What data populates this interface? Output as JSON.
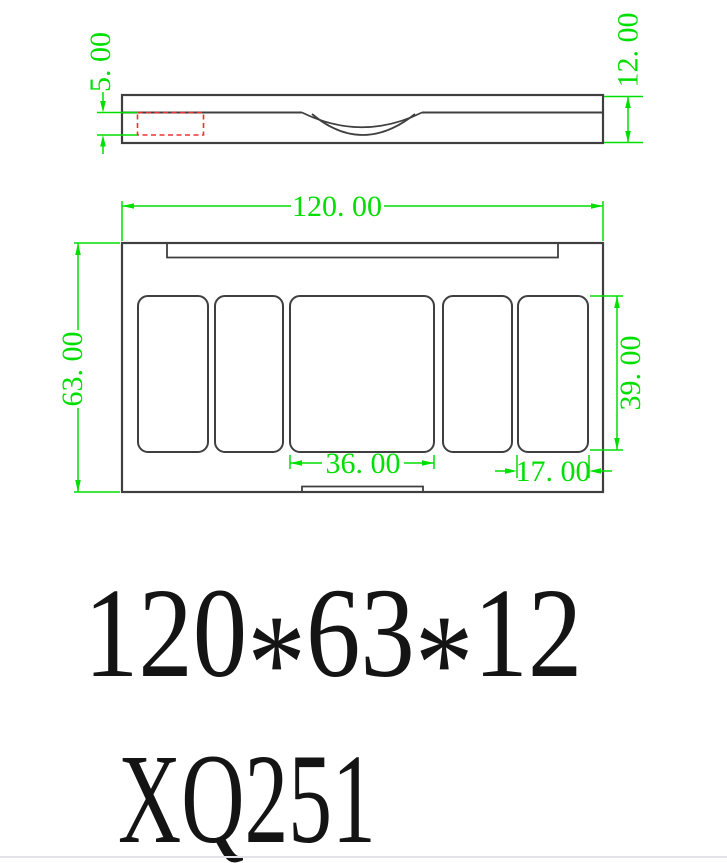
{
  "drawing": {
    "dimensions": {
      "lid_recess_depth": {
        "label": "5. 00"
      },
      "total_thickness": {
        "label": "12. 00"
      },
      "overall_width": {
        "label": "120. 00"
      },
      "overall_height": {
        "label": "63. 00"
      },
      "pan_height": {
        "label": "39. 00"
      },
      "center_pan_width": {
        "label": "36. 00"
      },
      "side_pan_width": {
        "label": "17. 00"
      }
    },
    "footer": {
      "size_text_parts": [
        "120",
        "*",
        "63",
        "*",
        "12"
      ],
      "model_code": "XQ251"
    },
    "colors": {
      "dimension_green": "#00df00",
      "highlight_red": "#f03030",
      "outline_dark": "#3f3f3f"
    }
  }
}
